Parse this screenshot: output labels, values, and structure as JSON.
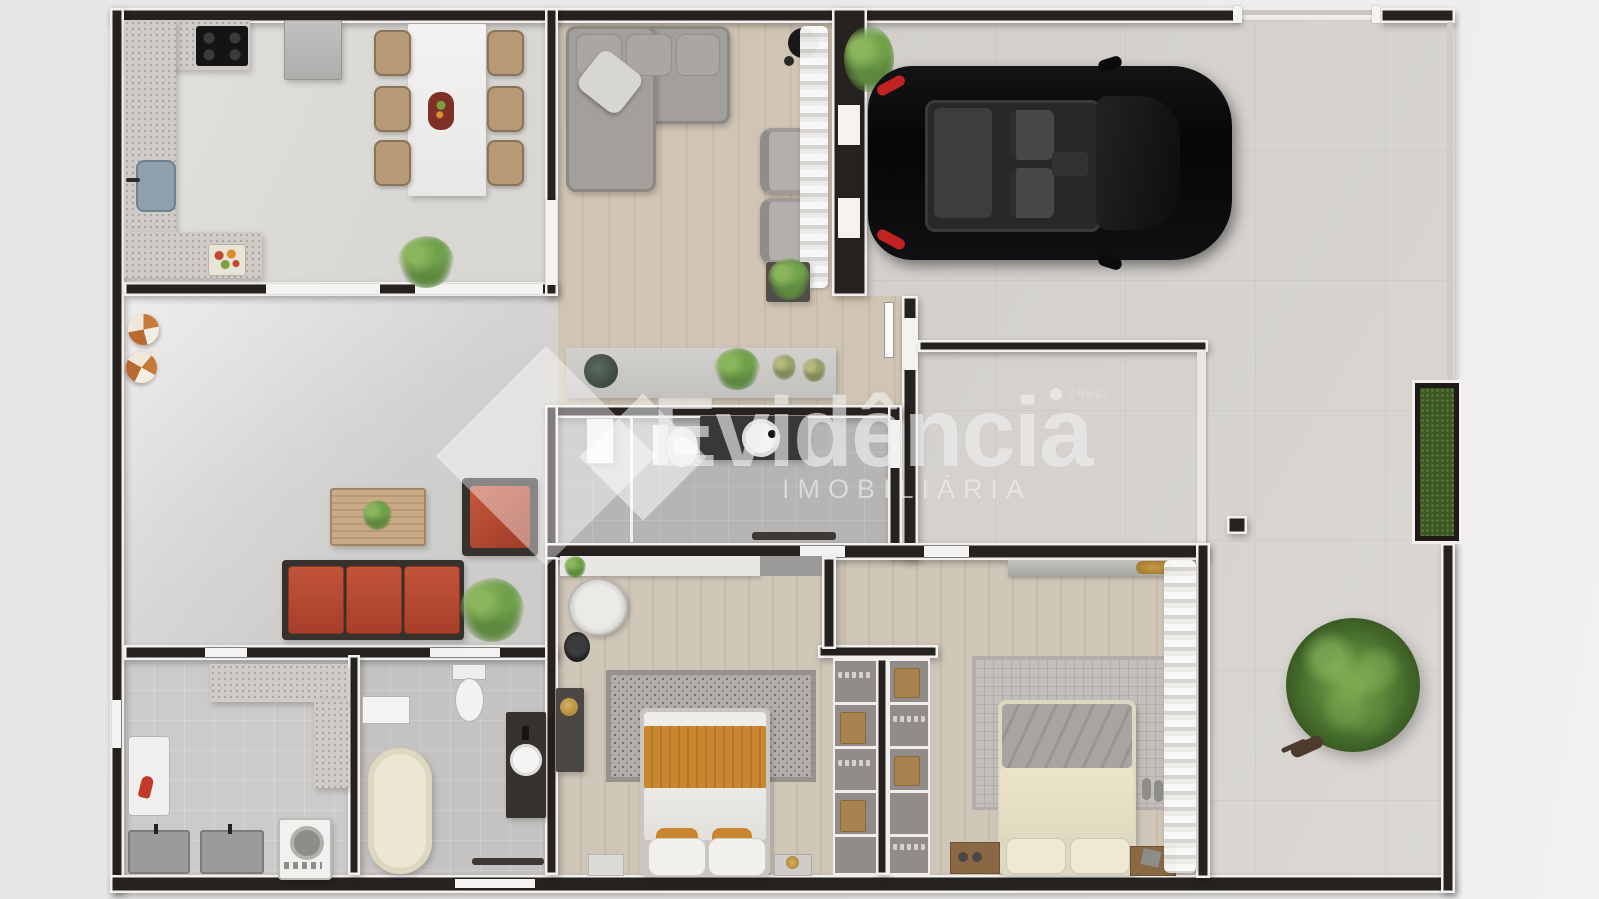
{
  "watermark": {
    "brand": "Evidência",
    "subtitle": "IMOBILIÁRIA",
    "registry_label": "CRECI"
  },
  "palette": {
    "wall": "#26221f",
    "trim": "#f2f1ef",
    "wood_floor": "#cdc3b2",
    "tile_floor": "#dedcd8",
    "concrete": "#d4d1cd",
    "bath_floor": "#b7b5b3",
    "accent_red_sofa": "#bb4a30",
    "blanket_orange": "#c8872f",
    "bed_cream": "#e9e1c6",
    "tree_green": "#4e7635",
    "car_black": "#0b0b0d",
    "car_taillight_red": "#c32222",
    "watermark_white": "rgba(252,252,251,0.58)"
  },
  "scene": {
    "type": "3d-top-view-floor-plan-render",
    "rooms": [
      "kitchen-dining",
      "living-room",
      "garage",
      "hallway",
      "central-bathroom",
      "family-room",
      "laundry-room",
      "bathtub-bathroom",
      "bedroom-1",
      "closet",
      "bedroom-2",
      "patio-backyard"
    ]
  }
}
